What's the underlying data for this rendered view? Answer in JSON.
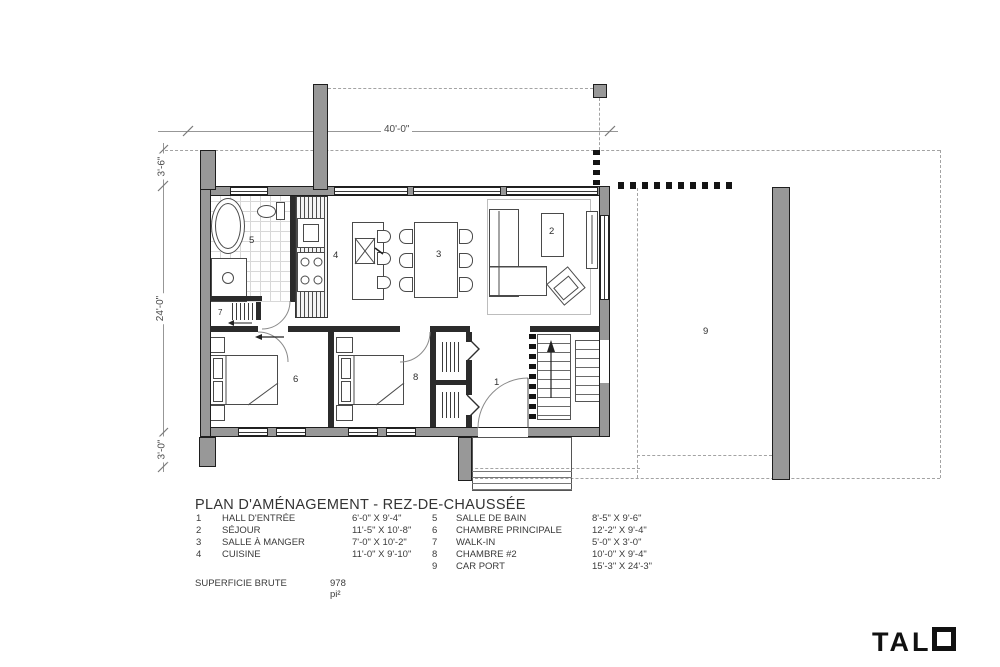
{
  "title": "PLAN D'AMÉNAGEMENT - REZ-DE-CHAUSSÉE",
  "summary": {
    "label": "SUPERFICIE BRUTE",
    "value": "978 pi²"
  },
  "dimensions": {
    "width_total": "40'-0\"",
    "left_top": "3'-6\"",
    "left_main": "24'-0\"",
    "left_bottom": "3'-0\""
  },
  "rooms": {
    "r1": "1",
    "r2": "2",
    "r3": "3",
    "r4": "4",
    "r5": "5",
    "r6": "6",
    "r7": "7",
    "r8": "8",
    "r9": "9"
  },
  "legend": {
    "left": [
      {
        "num": "1",
        "name": "HALL D'ENTRÉE",
        "size": "6'-0\" X 9'-4\""
      },
      {
        "num": "2",
        "name": "SÉJOUR",
        "size": "11'-5\" X 10'-8\""
      },
      {
        "num": "3",
        "name": "SALLE À MANGER",
        "size": "7'-0\" X 10'-2\""
      },
      {
        "num": "4",
        "name": "CUISINE",
        "size": "11'-0\" X 9'-10\""
      }
    ],
    "right": [
      {
        "num": "5",
        "name": "SALLE DE BAIN",
        "size": "8'-5\" X 9'-6\""
      },
      {
        "num": "6",
        "name": "CHAMBRE PRINCIPALE",
        "size": "12'-2\" X 9'-4\""
      },
      {
        "num": "7",
        "name": "WALK-IN",
        "size": "5'-0\" X 3'-0\""
      },
      {
        "num": "8",
        "name": "CHAMBRE #2",
        "size": "10'-0\" X 9'-4\""
      },
      {
        "num": "9",
        "name": "CAR PORT",
        "size": "15'-3\" X 24'-3\""
      }
    ]
  },
  "brand": {
    "name": "TALO",
    "prefix": "TAL"
  },
  "colors": {
    "wall": "#989898",
    "line": "#1e1e1e",
    "dashed": "#a3a3a3",
    "text": "#3a3a3a"
  }
}
